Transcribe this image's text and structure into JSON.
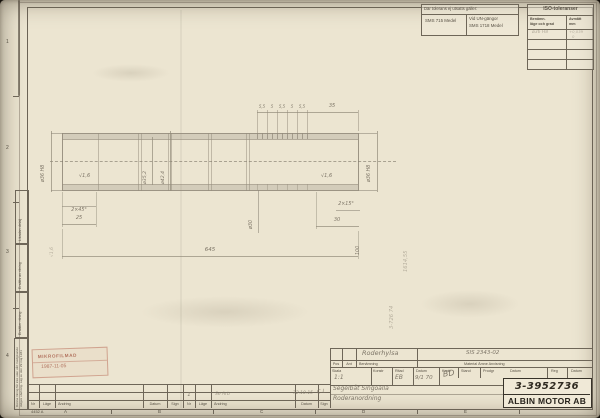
{
  "tolerance_note": {
    "title": "Där tolerans ej utsatts gäller:",
    "general": "SMS 715 Medel",
    "un_line1": "Vid UN-gängor",
    "un_line2": "SMS 1718 Medel"
  },
  "iso": {
    "title": "ISO-toleranser",
    "col1a": "Benämn.",
    "col1b": "läge och grad",
    "col2a": "Avmått",
    "col2b": "mm",
    "entry1": "ø36 H8",
    "entry2a": "+0,039",
    "entry2b": "0"
  },
  "margin": {
    "likadan": "Likadan detalj",
    "ersatts": "Ersätts av ritning",
    "ersatter": "Ersätter ritning",
    "legal": "Denna ritning får icke utan vårt medgivande delges obehörig. Lag av den 29 maj 1931",
    "zones": [
      "1",
      "2",
      "3",
      "4"
    ],
    "letters": [
      "A",
      "B",
      "C",
      "D",
      "E"
    ],
    "form": "4452 A"
  },
  "stamp": {
    "l1": "MIKROFILMAD",
    "l2": "1987-11-05"
  },
  "dwg": {
    "dia_left": "ø36 H8",
    "dia_right": "ø36 H8",
    "dia_inner": "ø35,2",
    "dia_outer": "ø42,4",
    "g": [
      "5,5",
      "5",
      "5,5",
      "5",
      "5,5"
    ],
    "d35": "35",
    "ch_l": "2×45°",
    "ch_r": "2×15°",
    "d25": "25",
    "d30": "30",
    "d645": "645",
    "d100": "100",
    "bore": "ø30",
    "surf_l": "√1,6",
    "surf_r": "√1,6",
    "surf_b": "√1,6",
    "note1": "1614,55",
    "note2": "3-726 74"
  },
  "tb": {
    "part": "Roderhylsa",
    "mtrl": "SIS 2343-02",
    "pos": "Pos",
    "ant": "Ant",
    "ben": "Benämning",
    "mtrl_h": "Material  Ämne  Anvisning",
    "skala": "Skala",
    "konstr": "Konstr",
    "ritad": "Ritad",
    "datum": "Datum",
    "kontr": "Kontr",
    "stand": "Stand",
    "prodgr": "Prodgr",
    "reg": "Reg",
    "skala_v": "1:1",
    "ritad_v": "EB",
    "datum_v": "9/1 70",
    "kontr_v": "BD",
    "proj1": "Segelbåt Singoalla",
    "proj2": "Roderanordning",
    "number": "3-3952736",
    "company": "ALBIN MOTOR AB"
  },
  "rev": {
    "nr": "Nr",
    "lage": "Läge",
    "andring": "Ändring",
    "datum": "Datum",
    "sign": "Sign",
    "e_nr": "1",
    "e_andring": "Se Arb",
    "e_datum": "72.10.15",
    "e_sign": "C.L"
  }
}
